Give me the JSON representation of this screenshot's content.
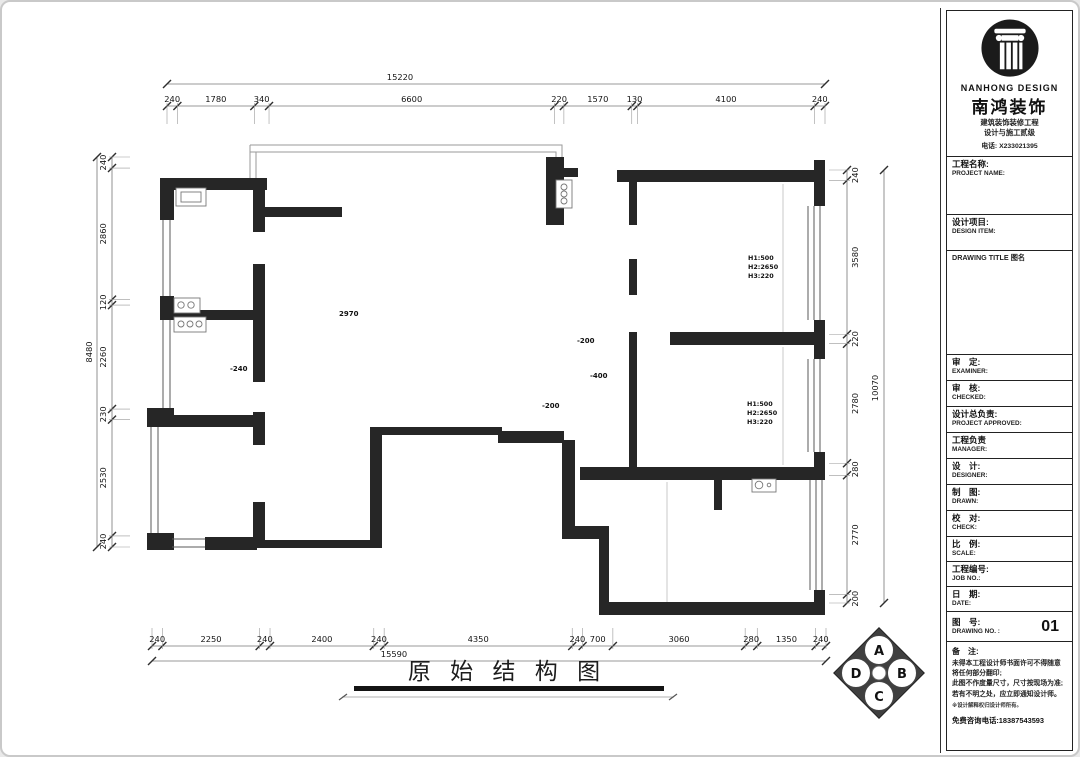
{
  "plan": {
    "title": "原 始 结 构 图",
    "height_label": "2970",
    "marks": {
      "m1": "-240",
      "m2": "-200",
      "m3": "-400",
      "m4": "-200"
    },
    "window_note": {
      "l1": "H1:500",
      "l2": "H2:2650",
      "l3": "H3:220"
    },
    "compass": {
      "a": "A",
      "b": "B",
      "c": "C",
      "d": "D"
    }
  },
  "dims": {
    "top": {
      "overall": "15220",
      "segments": [
        "240",
        "1780",
        "340",
        "6600",
        "220",
        "1570",
        "130",
        "4100",
        "240"
      ]
    },
    "bottom": {
      "overall": "15590",
      "segments": [
        "240",
        "2250",
        "240",
        "2400",
        "240",
        "4350",
        "240",
        "700",
        "3060",
        "280",
        "1350",
        "240"
      ]
    },
    "left": {
      "overall": "8480",
      "segments": [
        "240",
        "2860",
        "120",
        "2260",
        "230",
        "2530",
        "240"
      ]
    },
    "right": {
      "overall": "10070",
      "segments": [
        "240",
        "3580",
        "220",
        "2780",
        "280",
        "2770",
        "200"
      ]
    }
  },
  "titleblock": {
    "logo_en": "NANHONG DESIGN",
    "logo_cn": "南鸿装饰",
    "cert1": "建筑装饰装修工程",
    "cert2": "设计与施工贰级",
    "phone": "电话: X233021395",
    "rows": {
      "project_name": {
        "cn": "工程名称:",
        "en": "PROJECT NAME:"
      },
      "design_item": {
        "cn": "设计项目:",
        "en": "DESIGN ITEM:"
      },
      "drawing_title": {
        "cn": "DRAWING TITLE 图名"
      },
      "examiner": {
        "cn": "审　定:",
        "en": "EXAMINER:"
      },
      "checked": {
        "cn": "审　核:",
        "en": "CHECKED:"
      },
      "approved": {
        "cn": "设计总负责:",
        "en": "PROJECT APPROVED:"
      },
      "manager": {
        "cn": "工程负责",
        "en": "MANAGER:"
      },
      "designer": {
        "cn": "设　计:",
        "en": "DESIGNER:"
      },
      "drawn": {
        "cn": "制　图:",
        "en": "DRAWN:"
      },
      "check": {
        "cn": "校　对:",
        "en": "CHECK:"
      },
      "scale": {
        "cn": "比　例:",
        "en": "SCALE:"
      },
      "job_no": {
        "cn": "工程编号:",
        "en": "JOB NO.:"
      },
      "date": {
        "cn": "日　期:",
        "en": "DATE:"
      },
      "drawing_no": {
        "cn": "图　号:",
        "en": "DRAWING NO. :",
        "value": "01"
      }
    },
    "notes": {
      "title": "备　注:",
      "line1": "未得本工程设计师书面许可不得随意将任何部分翻印;",
      "line2": "此图不作度量尺寸，尺寸按现场为准;",
      "line3": "若有不明之处，应立即通知设计师。",
      "line4": "※设计解释权归设计师所有。",
      "line5": "免费咨询电话:18387543593"
    }
  }
}
